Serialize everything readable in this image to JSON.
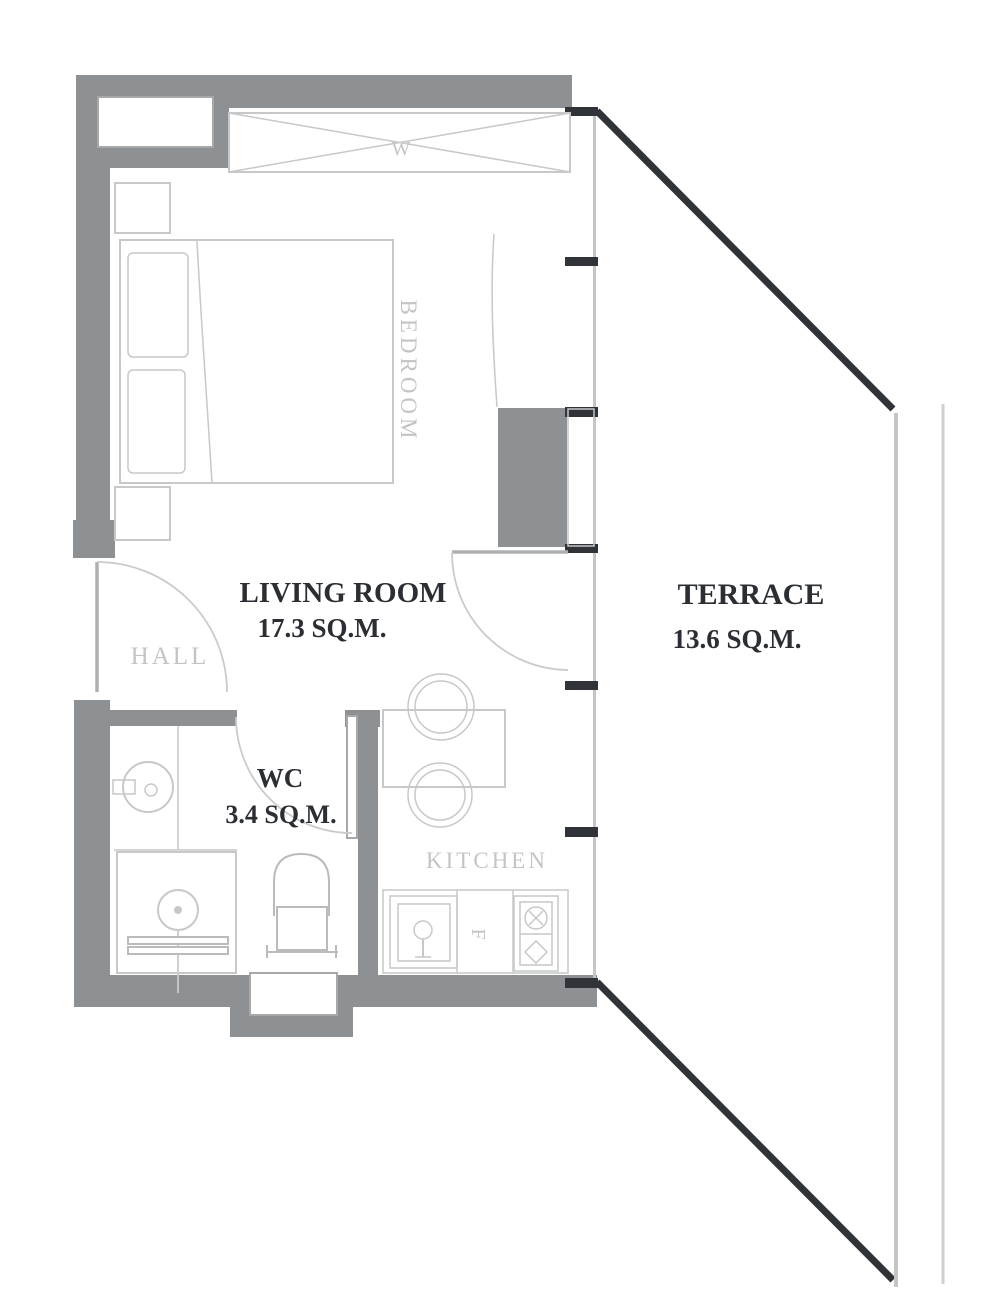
{
  "plan": {
    "rooms": {
      "bedroom": {
        "label": "BEDROOM"
      },
      "living_room": {
        "label": "LIVING ROOM",
        "area": "17.3 SQ.M."
      },
      "hall": {
        "label": "HALL"
      },
      "wc": {
        "label": "WC",
        "area": "3.4 SQ.M."
      },
      "kitchen": {
        "label": "KITCHEN"
      },
      "terrace": {
        "label": "TERRACE",
        "area": "13.6 SQ.M."
      }
    },
    "markers": {
      "wardrobe": "W",
      "fridge": "F"
    },
    "colors": {
      "background": "#ffffff",
      "wall": "#8e9194",
      "facade_dark": "#303438",
      "line_light": "#c3c5c7",
      "text_dark": "#2b2e32",
      "text_light": "#c2c4c5"
    }
  }
}
